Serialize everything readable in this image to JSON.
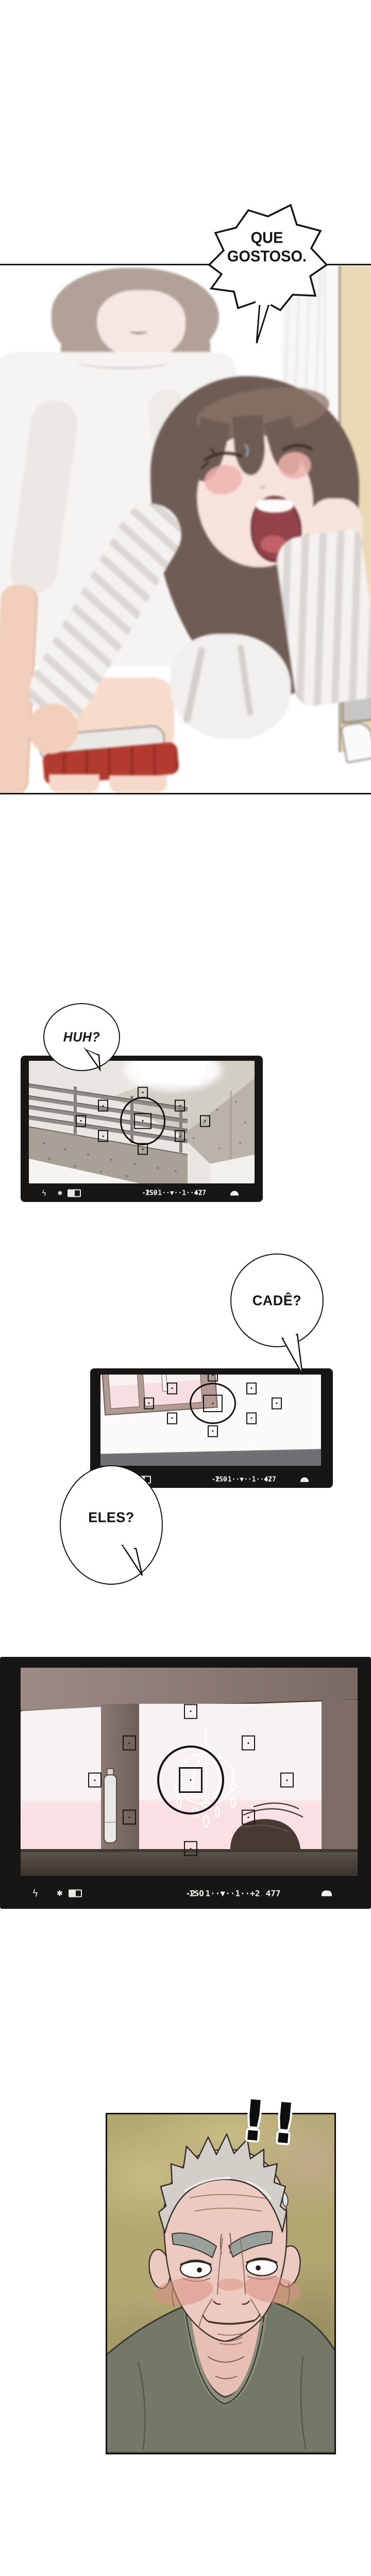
{
  "comic": {
    "bubbles": {
      "que": {
        "line1": "QUE",
        "line2": "GOSTOSO."
      },
      "huh": "HUH?",
      "cade": "CADÊ?",
      "eles": "ELES?"
    },
    "exclaim": "!!",
    "hud": {
      "flash": "ϟ",
      "ae_lock": "✱",
      "meter": "-2··1··▼··1··+2",
      "iso": "ISO",
      "counter": "477"
    },
    "colors": {
      "frame_black": "#171614",
      "pink_wall": "#f8dfe4",
      "beige_wall": "#ead9b4",
      "red_garment": "#b23a2f",
      "olive_bg": "#b2a771",
      "hud_text": "#f0efec"
    }
  }
}
